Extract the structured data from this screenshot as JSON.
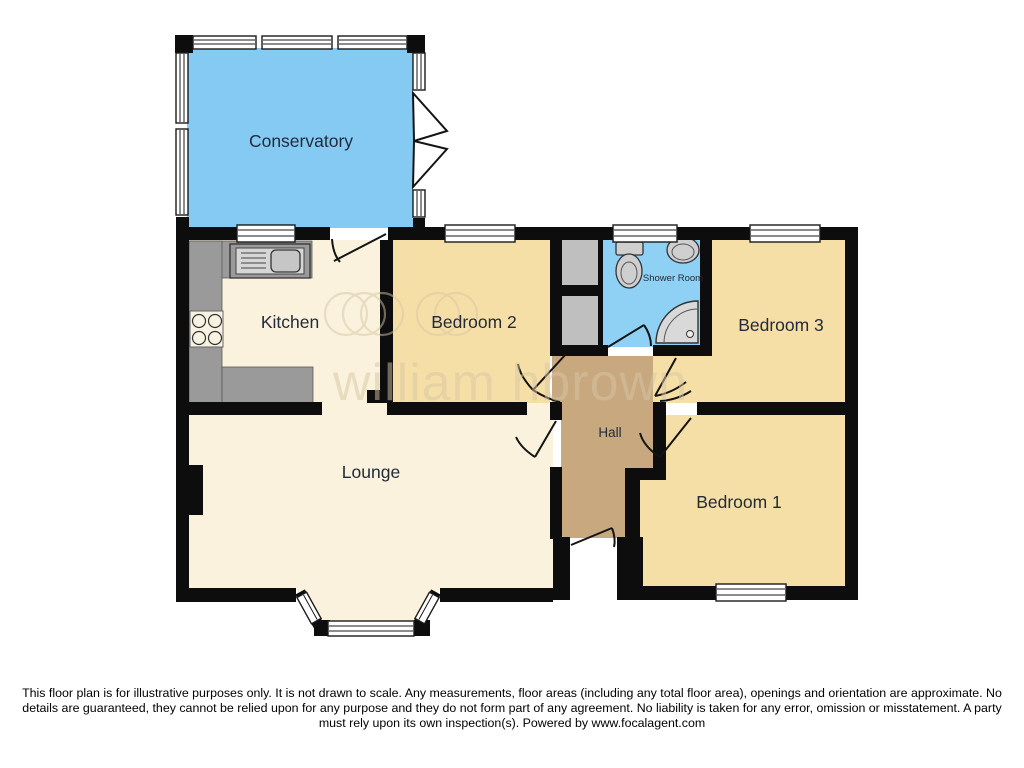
{
  "floorplan": {
    "colors": {
      "wall": "#0d0d0d",
      "conservatory_floor": "#85caf3",
      "shower_floor": "#8ed1f4",
      "bedroom_floor": "#f6dfa6",
      "living_floor": "#faf2dc",
      "hall_floor": "#c8a87e",
      "counter": "#9a9a9a",
      "cupboard": "#bfbfbf",
      "label_text": "#222b3a",
      "watermark": "#d7c7a5"
    },
    "rooms": {
      "conservatory": {
        "label": "Conservatory"
      },
      "kitchen": {
        "label": "Kitchen"
      },
      "bedroom2": {
        "label": "Bedroom 2"
      },
      "shower_room": {
        "label": "Shower Room"
      },
      "bedroom3": {
        "label": "Bedroom 3"
      },
      "lounge": {
        "label": "Lounge"
      },
      "hall": {
        "label": "Hall"
      },
      "bedroom1": {
        "label": "Bedroom 1"
      }
    },
    "watermark": {
      "brand_first": "william h",
      "brand_second": "brown"
    }
  },
  "disclaimer": {
    "lines": [
      "This floor plan is for illustrative purposes only. It is not drawn to scale. Any measurements, floor areas (including any total floor area), openings and orientation are approximate. No",
      "details are guaranteed, they cannot be relied upon for any purpose and they do not form part of any agreement. No liability is taken for any error, omission or misstatement. A party",
      "must rely upon its own inspection(s). Powered by www.focalagent.com"
    ]
  }
}
